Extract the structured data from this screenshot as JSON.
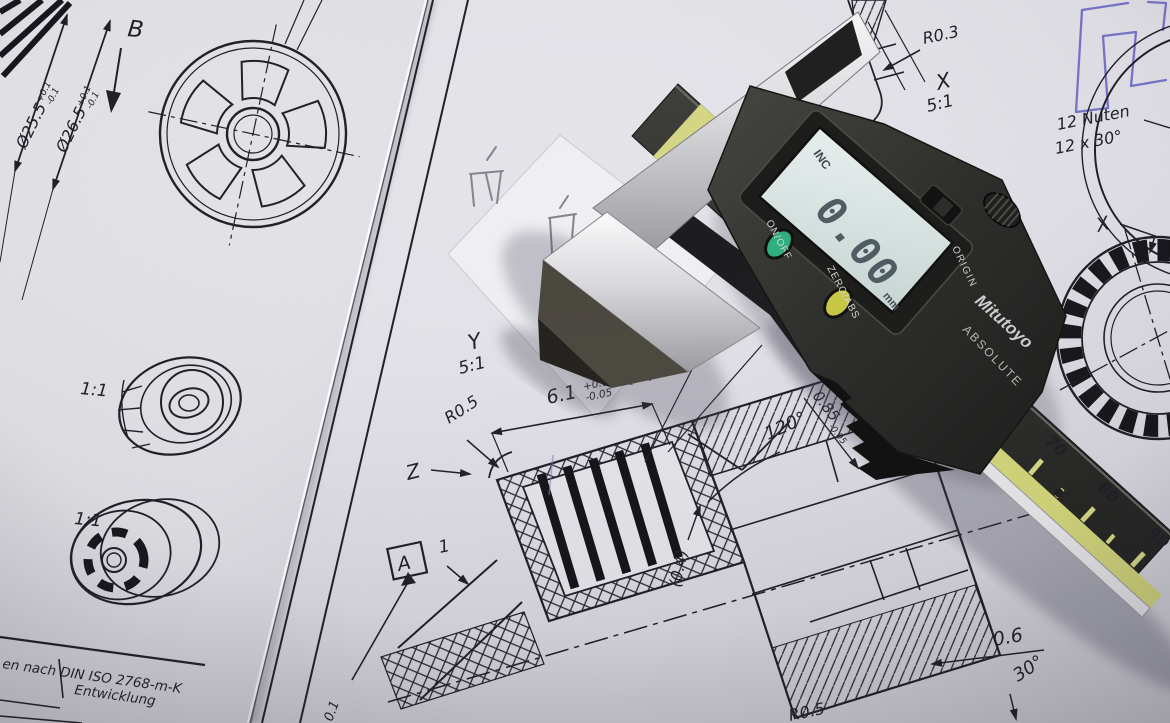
{
  "colors": {
    "pen_blue": "#6b68c8",
    "lcd_screen": "#dfe9e6",
    "button_green": "#2fae7e",
    "button_yellow": "#c8c843",
    "scale_yellow": "#d4d77a",
    "steel": "#d8d8da",
    "caliper_body": "#2b2b29",
    "drawing_ink": "#1e1e26"
  },
  "left_sheet": {
    "view_label": "B",
    "dia1": "Ø25.5",
    "dia1_up": "+0.1",
    "dia1_dn": "-0.1",
    "dia2": "Ø26.5",
    "dia2_up": "+0.1",
    "dia2_dn": "-0.1",
    "scale_a": "1:1",
    "scale_b": "1:1",
    "title_norm": "en nach DIN ISO 2768-m-K",
    "title_dev": "Entwicklung"
  },
  "right_sheet": {
    "r03": "R0.3",
    "detail_x_label": "X",
    "detail_x_scale": "5:1",
    "note_nuten": "12 Nuten",
    "note_nuten2": "12 x 30°",
    "x_ref": "X",
    "detail_y_label": "Y",
    "detail_y_scale": "5:1",
    "d61": "6.1",
    "d61_up": "+0.05",
    "d61_dn": "-0.05",
    "r05": "R0.5",
    "z_label": "Z",
    "dim_one_a": "1",
    "dim_one_b": "1",
    "angle_120": "120°",
    "d085": "0.85",
    "d085_tol": "-0.05",
    "d04": "(0.4)",
    "datum_a": "A",
    "d06": "0.6",
    "angle_30": "30°",
    "r05_bottom": "R0.5",
    "d01_partial": "0.1"
  },
  "caliper": {
    "mode": "INC",
    "value": "0.00",
    "unit": "mm",
    "btn_power": "ON/OFF",
    "btn_zero": "ZERO/ABS",
    "btn_origin": "ORIGIN",
    "brand": "Mitutoyo",
    "brand_tech": "ABSOLUTE",
    "scale_zero": "0",
    "scale_70": "70",
    "scale_80": "80",
    "scale_90": "90"
  }
}
